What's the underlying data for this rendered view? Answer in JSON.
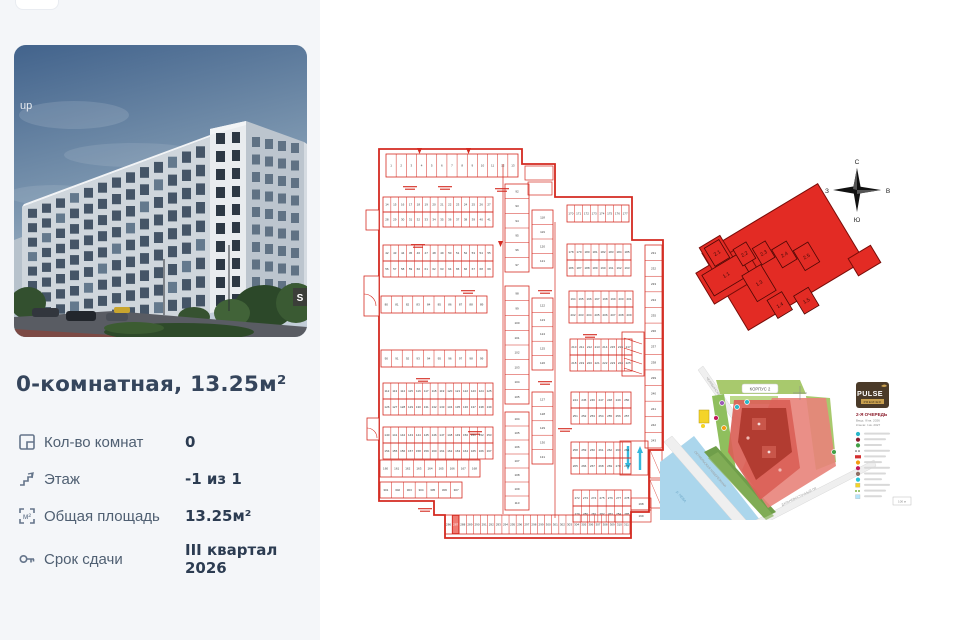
{
  "page": {
    "background": "#ffffff",
    "sidebar_background": "#f4f6f9"
  },
  "listing": {
    "title": "0-комнатная, 13.25м²",
    "photo_watermark": "up",
    "photo_badge": "S",
    "specs": [
      {
        "icon": "rooms-icon",
        "label": "Кол-во комнат",
        "value": "0"
      },
      {
        "icon": "floor-icon",
        "label": "Этаж",
        "value": "-1 из 1"
      },
      {
        "icon": "area-icon",
        "label": "Общая площадь",
        "value": "13.25м²"
      },
      {
        "icon": "deadline-icon",
        "label": "Срок сдачи",
        "value": "III квартал 2026"
      }
    ]
  },
  "compass": {
    "n": "С",
    "s": "Ю",
    "w": "З",
    "e": "В"
  },
  "masterplan": {
    "fill": "#e32b24",
    "sections": [
      "2.1",
      "1.1",
      "2.2",
      "2.3",
      "2.4",
      "2.5",
      "1.3",
      "1.4",
      "1.5"
    ]
  },
  "floor_plan": {
    "line_color": "#d42a20",
    "number_color": "#3a3a3a",
    "highlight_color": "#ef7b72",
    "arrow_color": "#35b8dc",
    "rows": [
      {
        "x": 388,
        "y": 156,
        "w": 132,
        "h": 23,
        "n": 13,
        "start": 1
      },
      {
        "x": 385,
        "y": 199,
        "w": 110,
        "h": 15,
        "n": 14,
        "start": 14
      },
      {
        "x": 385,
        "y": 214,
        "w": 110,
        "h": 15,
        "n": 14,
        "start": 28
      },
      {
        "x": 385,
        "y": 247,
        "w": 110,
        "h": 16,
        "n": 14,
        "start": 42
      },
      {
        "x": 385,
        "y": 263,
        "w": 110,
        "h": 16,
        "n": 14,
        "start": 56
      },
      {
        "x": 383,
        "y": 298,
        "w": 106,
        "h": 17,
        "n": 10,
        "start": 80
      },
      {
        "x": 383,
        "y": 352,
        "w": 106,
        "h": 17,
        "n": 10,
        "start": 90
      },
      {
        "x": 385,
        "y": 385,
        "w": 110,
        "h": 16,
        "n": 14,
        "start": 112
      },
      {
        "x": 385,
        "y": 401,
        "w": 110,
        "h": 16,
        "n": 14,
        "start": 126
      },
      {
        "x": 385,
        "y": 429,
        "w": 110,
        "h": 16,
        "n": 14,
        "start": 140
      },
      {
        "x": 385,
        "y": 445,
        "w": 110,
        "h": 16,
        "n": 14,
        "start": 154
      },
      {
        "x": 382,
        "y": 462,
        "w": 100,
        "h": 17,
        "n": 9,
        "start": 160
      },
      {
        "x": 382,
        "y": 484,
        "w": 82,
        "h": 16,
        "n": 7,
        "start": 301
      },
      {
        "x": 569,
        "y": 207,
        "w": 62,
        "h": 17,
        "n": 8,
        "start": 170
      },
      {
        "x": 569,
        "y": 246,
        "w": 64,
        "h": 16,
        "n": 8,
        "start": 178
      },
      {
        "x": 569,
        "y": 262,
        "w": 64,
        "h": 16,
        "n": 8,
        "start": 186
      },
      {
        "x": 571,
        "y": 293,
        "w": 64,
        "h": 16,
        "n": 8,
        "start": 194
      },
      {
        "x": 571,
        "y": 309,
        "w": 64,
        "h": 16,
        "n": 8,
        "start": 202
      },
      {
        "x": 572,
        "y": 341,
        "w": 62,
        "h": 16,
        "n": 8,
        "start": 210
      },
      {
        "x": 572,
        "y": 357,
        "w": 62,
        "h": 16,
        "n": 8,
        "start": 218
      },
      {
        "x": 573,
        "y": 394,
        "w": 60,
        "h": 16,
        "n": 7,
        "start": 244
      },
      {
        "x": 573,
        "y": 410,
        "w": 60,
        "h": 16,
        "n": 7,
        "start": 251
      },
      {
        "x": 573,
        "y": 444,
        "w": 60,
        "h": 16,
        "n": 7,
        "start": 258
      },
      {
        "x": 573,
        "y": 460,
        "w": 60,
        "h": 16,
        "n": 7,
        "start": 265
      },
      {
        "x": 575,
        "y": 492,
        "w": 58,
        "h": 16,
        "n": 7,
        "start": 272
      },
      {
        "x": 575,
        "y": 508,
        "w": 58,
        "h": 16,
        "n": 7,
        "start": 279
      },
      {
        "x": 647,
        "y": 247,
        "w": 17,
        "h": 203,
        "n": 13,
        "start": 231,
        "vertical": true
      },
      {
        "x": 447,
        "y": 517,
        "w": 185,
        "h": 19,
        "n": 26,
        "start": 286,
        "highlight": 1
      }
    ],
    "stacks": [
      {
        "x": 507,
        "y": 186,
        "w": 24,
        "h": 88,
        "n": 6,
        "start": 92
      },
      {
        "x": 507,
        "y": 288,
        "w": 24,
        "h": 118,
        "n": 8,
        "start": 98
      },
      {
        "x": 507,
        "y": 414,
        "w": 24,
        "h": 98,
        "n": 7,
        "start": 104
      },
      {
        "x": 534,
        "y": 212,
        "w": 21,
        "h": 58,
        "n": 4,
        "start": 118
      },
      {
        "x": 534,
        "y": 300,
        "w": 21,
        "h": 72,
        "n": 5,
        "start": 122
      },
      {
        "x": 534,
        "y": 394,
        "w": 21,
        "h": 72,
        "n": 5,
        "start": 127
      }
    ],
    "small_rooms": [
      {
        "x": 633,
        "y": 500,
        "w": 20,
        "h": 12,
        "num": "198"
      },
      {
        "x": 633,
        "y": 512,
        "w": 20,
        "h": 12,
        "num": "199"
      }
    ]
  },
  "site_map": {
    "korpus_label": "КОРПУС 2",
    "river_label": "р. НЕВА",
    "street_top": "ЧЕЛЯБИНСКАЯ УЛ.",
    "street_river": "ОКТЯБРЬСКАЯ НАБЕРЕЖНАЯ",
    "street_right": "ДАЛЬНЕВОСТОЧНЫЙ ПР.",
    "logo": "PULSE",
    "logo_sub": "PREMIER",
    "queue_title": "2-Я ОЧЕРЕДЬ",
    "queue_line1": "Ввод: III кв. 2026",
    "queue_line2": "Ключи: I кв. 2027",
    "scale_label": "100 м",
    "legend_colors": [
      "#2ab7ca",
      "#8b1e2d",
      "#43a047",
      "#9e9e9e",
      "#d32f2f",
      "#f39c12",
      "#c2185b",
      "#8d6e63",
      "#26c6da",
      "#f4d428",
      "#7cb342",
      "#b3e5fc"
    ]
  }
}
